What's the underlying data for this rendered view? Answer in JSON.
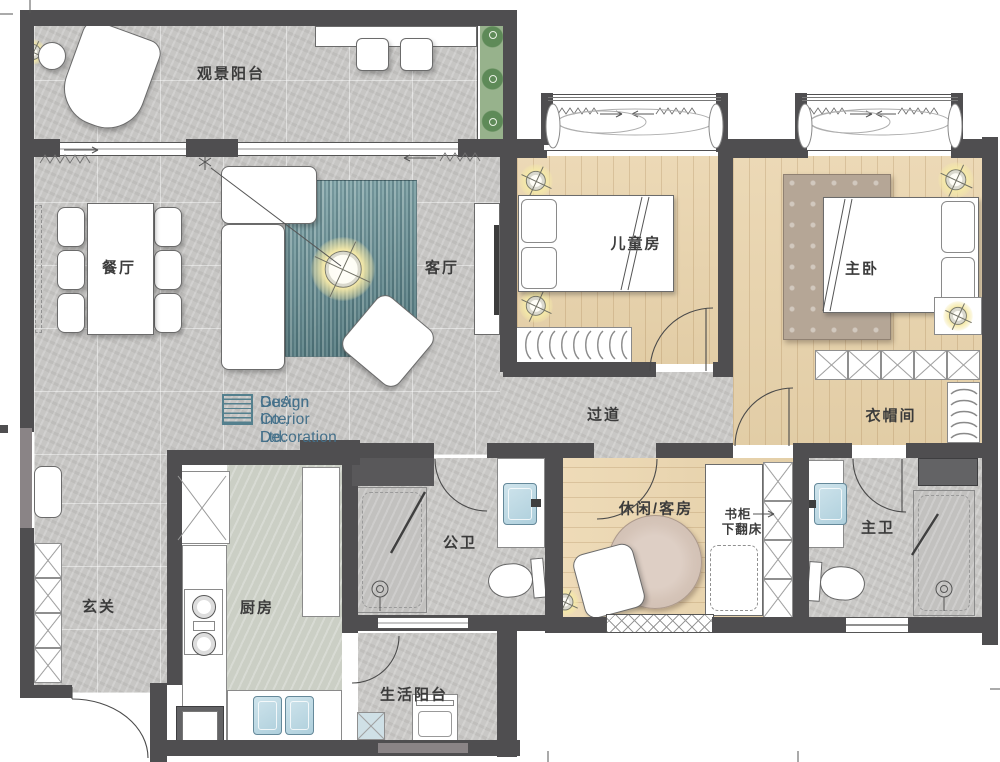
{
  "logo": {
    "line1": "GuAnn Interior Decoration",
    "line2": "Design Co., Ltd."
  },
  "rooms": {
    "viewing_balcony": {
      "label": "观景阳台"
    },
    "dining": {
      "label": "餐厅"
    },
    "living": {
      "label": "客厅"
    },
    "kids_room": {
      "label": "儿童房"
    },
    "master_bedroom": {
      "label": "主卧"
    },
    "hallway": {
      "label": "过道"
    },
    "cloakroom": {
      "label": "衣帽间"
    },
    "public_bathroom": {
      "label": "公卫"
    },
    "leisure_guest_room": {
      "label": "休闲/客房"
    },
    "master_bathroom": {
      "label": "主卫"
    },
    "foyer": {
      "label": "玄关"
    },
    "kitchen": {
      "label": "厨房"
    },
    "service_balcony": {
      "label": "生活阳台"
    }
  },
  "annotations": {
    "bookcase_label": "书柜",
    "fold_bed_label": "下翻床"
  },
  "colors": {
    "wall": "#4f4e50",
    "wood_floor": "#e7d3ae",
    "stone_floor": "#c9c8c6",
    "rug_teal": "#5f868c",
    "logo_teal": "#44708a",
    "lamp_yellow": "#f5e9a8",
    "fixture_blue": "#bcd9e3",
    "plant_green": "#8fae85"
  }
}
